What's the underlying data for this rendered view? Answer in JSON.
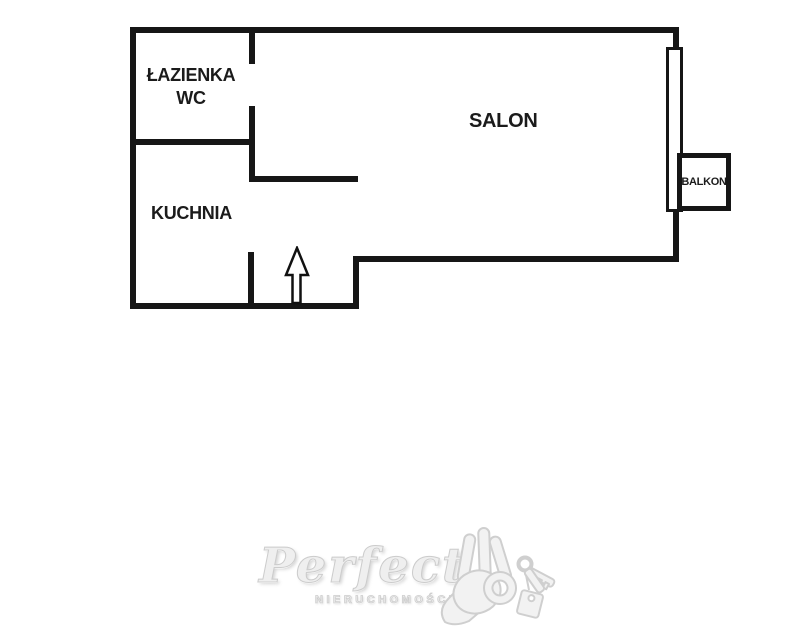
{
  "colors": {
    "wall": "#161616",
    "background": "#ffffff",
    "label_text": "#1b1b1b",
    "watermark": "#eeeeee"
  },
  "floorplan": {
    "rooms": {
      "bathroom": {
        "line1": "ŁAZIENKA",
        "line2": "WC"
      },
      "kitchen": {
        "label": "KUCHNIA"
      },
      "living_room": {
        "label": "SALON"
      },
      "balcony": {
        "label": "BALKON"
      }
    },
    "symbols": {
      "entrance_arrow": "up-arrow",
      "window": "double-line-window"
    }
  },
  "watermark": {
    "brand": "Perfect",
    "subtitle": "NIERUCHOMOŚCI",
    "icon": "ok-hand-with-keys"
  }
}
